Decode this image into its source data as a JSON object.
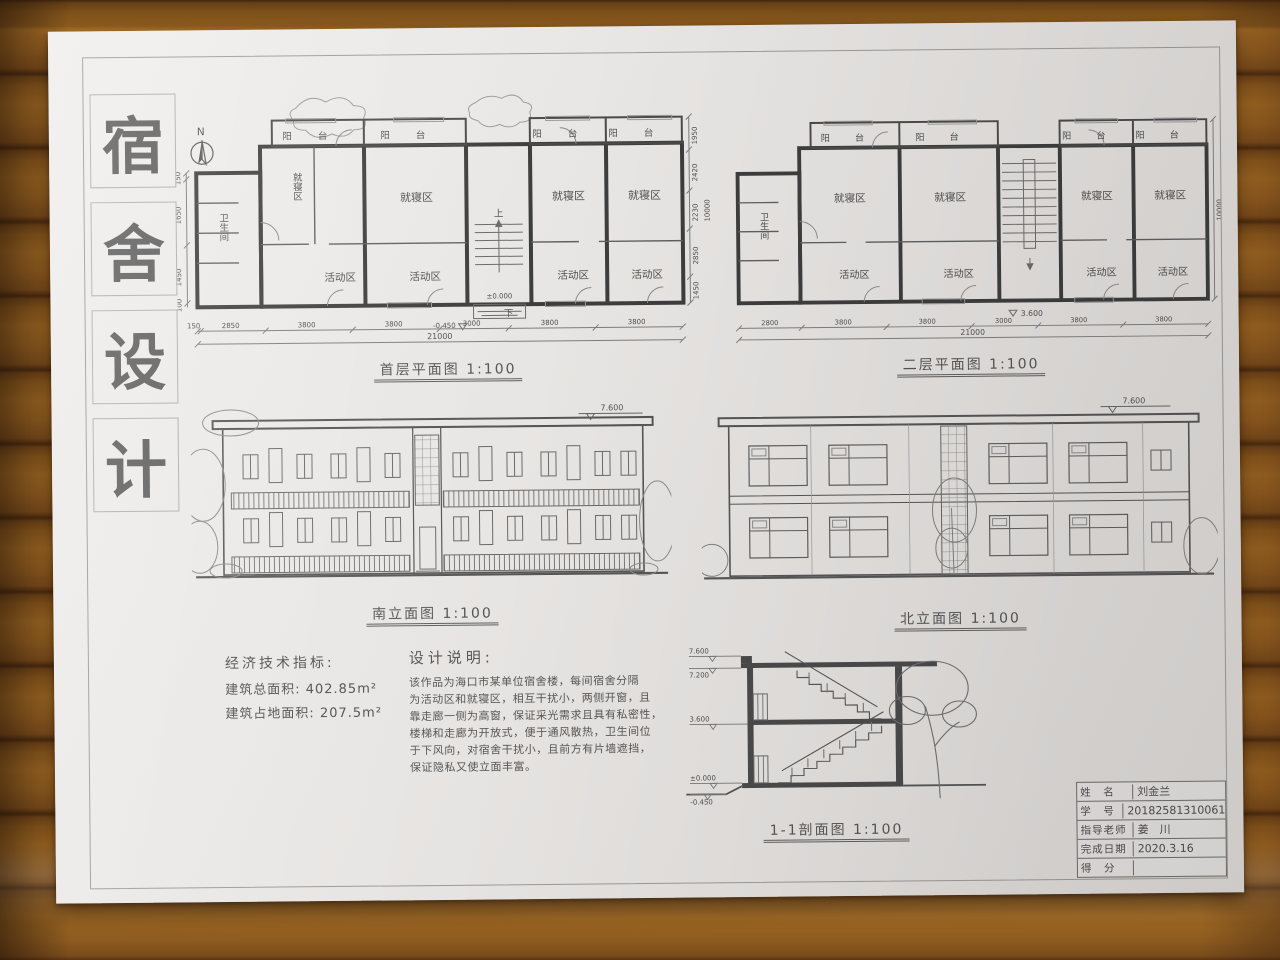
{
  "sheet": {
    "title_chars": [
      "宿",
      "舍",
      "设",
      "计"
    ],
    "compass": "N"
  },
  "labels": {
    "balcony": "阳台",
    "sleep": "就寝区",
    "activity": "活动区",
    "bath": "卫生间",
    "up": "上",
    "down": "下"
  },
  "plans": {
    "first": {
      "caption": "首层平面图 1:100",
      "levels": {
        "zero": "±0.000",
        "entry": "-0.450"
      },
      "dims_bottom": [
        "150",
        "2850",
        "3800",
        "3800",
        "3000",
        "3800",
        "3800"
      ],
      "dim_total": "21000",
      "dims_right": [
        "1950",
        "2420",
        "2230",
        "2850",
        "1450"
      ],
      "dim_right_total": "10000",
      "dims_left": [
        "150",
        "1650",
        "1450",
        "100"
      ]
    },
    "second": {
      "caption": "二层平面图 1:100",
      "levels": {
        "floor": "3.600"
      },
      "dims_bottom": [
        "2800",
        "3800",
        "3800",
        "3000",
        "3800",
        "3800"
      ],
      "dim_total": "21000",
      "dim_right_total": "10000"
    }
  },
  "elevations": {
    "south": {
      "caption": "南立面图 1:100",
      "top_level": "7.600"
    },
    "north": {
      "caption": "北立面图 1:100",
      "top_level": "7.600"
    }
  },
  "section": {
    "caption": "1-1剖面图 1:100",
    "levels": [
      "7.600",
      "7.200",
      "3.600",
      "±0.000",
      "-0.450"
    ]
  },
  "indicators": {
    "heading": "经济技术指标:",
    "lines": [
      "建筑总面积: 402.85m²",
      "建筑占地面积: 207.5m²"
    ]
  },
  "notes": {
    "heading": "设计说明:",
    "lines": [
      "该作品为海口市某单位宿舍楼，每间宿舍分隔",
      "为活动区和就寝区，相互干扰小，两侧开窗，且",
      "靠走廊一侧为高窗，保证采光需求且具有私密性，",
      "楼梯和走廊为开放式，便于通风散热，卫生间位",
      "于下风向，对宿舍干扰小，且前方有片墙遮挡，",
      "保证隐私又使立面丰富。"
    ]
  },
  "titleblock": {
    "rows": [
      {
        "label": "姓　名",
        "value": "刘金兰"
      },
      {
        "label": "学　号",
        "value": "20182581310061"
      },
      {
        "label": "指导老师",
        "value": "姜　川"
      },
      {
        "label": "完成日期",
        "value": "2020.3.16"
      },
      {
        "label": "得　分",
        "value": ""
      }
    ]
  }
}
